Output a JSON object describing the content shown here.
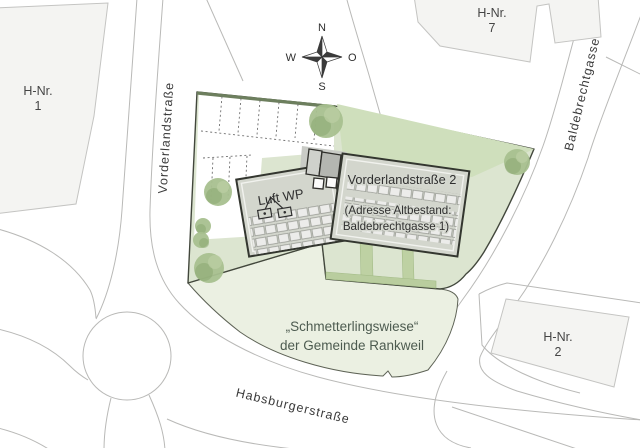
{
  "document": {
    "type": "site-plan",
    "municipality": "Rankweil"
  },
  "colors": {
    "background": "#ffffff",
    "parcel_green": "#dce5d0",
    "north_strip_green": "#cfdfbc",
    "meadow_green": "#ebf0e2",
    "hedge_green": "#b9cd9e",
    "tree_green": "#a8c08f",
    "building_gray": "#d3d6cd",
    "neighbor_building_gray": "#f4f4f2",
    "road_line_gray": "#b9b9b7",
    "boundary_dark": "#42473c",
    "text_dark": "#3c3c3c",
    "meadow_text_green": "#4d5b50"
  },
  "compass": {
    "north": "N",
    "east": "O",
    "south": "S",
    "west": "W"
  },
  "streets": {
    "west": "Vorderlandstraße",
    "east": "Baldebrechtgasse",
    "south": "Habsburgerstraße"
  },
  "neighbors": {
    "hnr1": {
      "line1": "H-Nr.",
      "line2": "1"
    },
    "hnr7": {
      "line1": "H-Nr.",
      "line2": "7"
    },
    "hnr2": {
      "line1": "H-Nr.",
      "line2": "2"
    }
  },
  "site": {
    "heat_pump_label": "Luft WP",
    "main_building": {
      "line1": "Vorderlandstraße 2",
      "line2": "(Adresse Altbestand:",
      "line3": "Baldebrechtgasse 1)"
    },
    "meadow": {
      "line1": "„Schmetterlingswiese“",
      "line2": "der Gemeinde Rankweil"
    }
  }
}
